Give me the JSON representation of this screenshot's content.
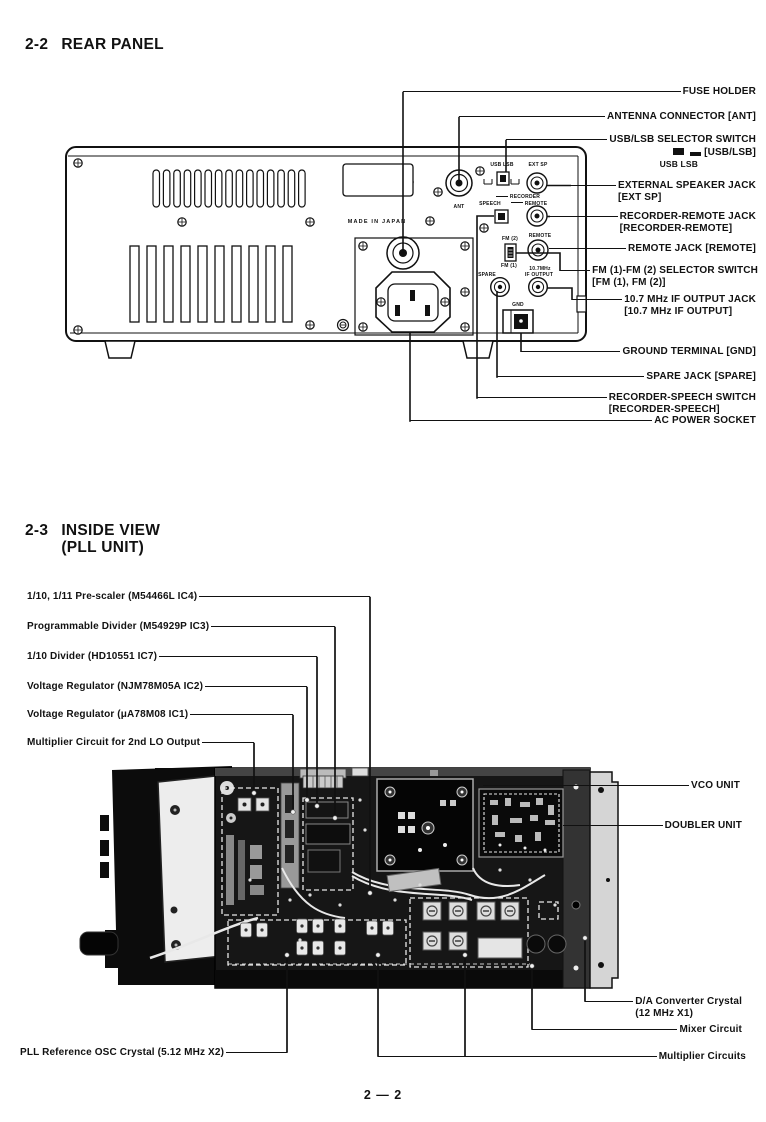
{
  "page_number": "2 — 2",
  "rear": {
    "number": "2-2",
    "title": "REAR PANEL",
    "panel_labels": {
      "usb_lsb": "USB LSB",
      "ext_sp": "EXT SP",
      "recorder": "RECORDER",
      "speech": "SPEECH",
      "remote_upper": "REMOTE",
      "fm2": "FM (2)",
      "fm1": "FM (1)",
      "remote_lower": "REMOTE",
      "mhz": "10.7MHz",
      "if_output": "IF OUTPUT",
      "spare": "SPARE",
      "gnd": "GND",
      "ant": "ANT",
      "made_in_japan": "MADE IN JAPAN"
    },
    "callouts": [
      {
        "text": "FUSE HOLDER"
      },
      {
        "text": "ANTENNA CONNECTOR [ANT]"
      },
      {
        "text": "USB/LSB SELECTOR SWITCH",
        "bracket": "[USB/LSB]",
        "switch_caption": "USB LSB"
      },
      {
        "text": "EXTERNAL SPEAKER JACK",
        "sub": "[EXT SP]"
      },
      {
        "text": "RECORDER-REMOTE JACK",
        "sub": "[RECORDER-REMOTE]"
      },
      {
        "text": "REMOTE JACK [REMOTE]"
      },
      {
        "text": "FM (1)-FM (2) SELECTOR SWITCH",
        "sub": "[FM (1), FM (2)]"
      },
      {
        "text": "10.7 MHz IF OUTPUT JACK",
        "sub": "[10.7 MHz IF OUTPUT]"
      },
      {
        "text": "GROUND TERMINAL [GND]"
      },
      {
        "text": "SPARE JACK [SPARE]"
      },
      {
        "text": "RECORDER-SPEECH SWITCH",
        "sub": "[RECORDER-SPEECH]"
      },
      {
        "text": "AC POWER SOCKET"
      }
    ]
  },
  "inside": {
    "number": "2-3",
    "title": "INSIDE VIEW",
    "subtitle": "(PLL UNIT)",
    "callouts_left": [
      {
        "text": "1/10, 1/11 Pre-scaler (M54466L IC4)"
      },
      {
        "text": "Programmable Divider (M54929P IC3)"
      },
      {
        "text": "1/10 Divider (HD10551 IC7)"
      },
      {
        "text": "Voltage Regulator (NJM78M05A IC2)"
      },
      {
        "text": "Voltage Regulator (μA78M08 IC1)"
      },
      {
        "text": "Multiplier Circuit for 2nd LO Output"
      }
    ],
    "callouts_right": [
      {
        "text": "VCO UNIT"
      },
      {
        "text": "DOUBLER UNIT"
      },
      {
        "text": "D/A Converter Crystal",
        "sub": "(12 MHz X1)"
      },
      {
        "text": "Mixer Circuit"
      },
      {
        "text": "Multiplier Circuits"
      }
    ],
    "callout_bottom_left": {
      "text": "PLL Reference OSC Crystal (5.12 MHz X2)"
    }
  }
}
